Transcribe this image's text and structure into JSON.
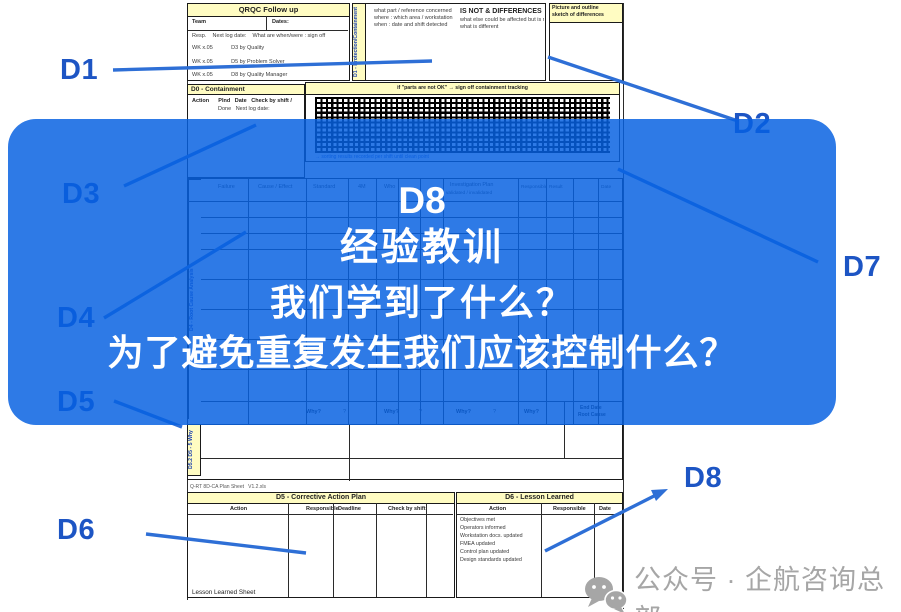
{
  "slide": {
    "callouts": {
      "d1": "D1",
      "d2": "D2",
      "d3": "D3",
      "d4": "D4",
      "d5": "D5",
      "d6": "D6",
      "d7": "D7",
      "d8": "D8"
    },
    "overlay": {
      "heading": "D8",
      "line1": "经验教训",
      "line2": "我们学到了什么？",
      "line3": "为了避免重复发生我们应该控制什么？",
      "accent_color": "#2E7AE6",
      "text_color": "#FFFFFF"
    },
    "watermark": {
      "label": "公众号 · 企航咨询总部",
      "icon": "wechat-icon",
      "color": "#A6A6A6"
    }
  },
  "form": {
    "followup": {
      "title": "QRQC Follow up",
      "team": "Team",
      "dates": "Dates:",
      "row1": "Resp.    Next log date:    What are when/were : sign off",
      "row2": "WK x.05            D3 by Quality",
      "row3": "WK x.05            D5 by Problem Solver",
      "row4": "WK x.05            D8 by Quality Manager"
    },
    "containment": {
      "title": "D0 - Containment",
      "row1": "Action      Plnd   Date   Check by shift /",
      "row2": "                 Done   Next log date:"
    },
    "problem": {
      "strip": "D1 - Protection/Containment",
      "bullet1": "what part / reference concerned",
      "bullet2": "where : which area / workstation",
      "bullet3": "when : date and shift detected",
      "isnot_title": "IS NOT & DIFFERENCES",
      "isnot_line1": "what else could be affected but is not,",
      "isnot_line2": "what is different"
    },
    "picture": {
      "line1": "Picture and outline",
      "line2": "sketch of differences"
    },
    "tracking": {
      "title": "if \"parts are not OK\" → sign off  containment tracking",
      "caption": "→ sorting results recorded per shift until clean point"
    },
    "analysis": {
      "strip": "D4 - Root Cause Analysis",
      "cols": [
        "Failure",
        "Cause / Effect",
        "Standard",
        "4M",
        "Who",
        "Investigation Plan",
        "validated / invalidated",
        "Responsible",
        "Result",
        "Date"
      ]
    },
    "five_why": {
      "strip": "D5.2  D5 - 5 Why",
      "cells": [
        "Why?",
        "?",
        "Why?",
        "?",
        "Why?",
        "?",
        "Why?"
      ],
      "end1": "End Date",
      "end2": "Root Cause"
    },
    "footer_file": "Q-RT 8D-CA Plan Sheet   V1.2.xls",
    "corrective": {
      "title": "D5 - Corrective Action Plan",
      "col1": "Action",
      "col2": "Responsible",
      "col3": "Deadline",
      "col4": "Check by shift"
    },
    "lesson": {
      "title": "D6 - Lesson Learned",
      "col1": "Action",
      "col2": "Responsible",
      "col3": "Date",
      "items": [
        "Objectives met",
        "Operators informed",
        "Workstation docs. updated",
        "FMEA updated",
        "Control plan updated",
        "Design standards updated"
      ]
    },
    "lesson_sheet": "Lesson Learned Sheet"
  }
}
